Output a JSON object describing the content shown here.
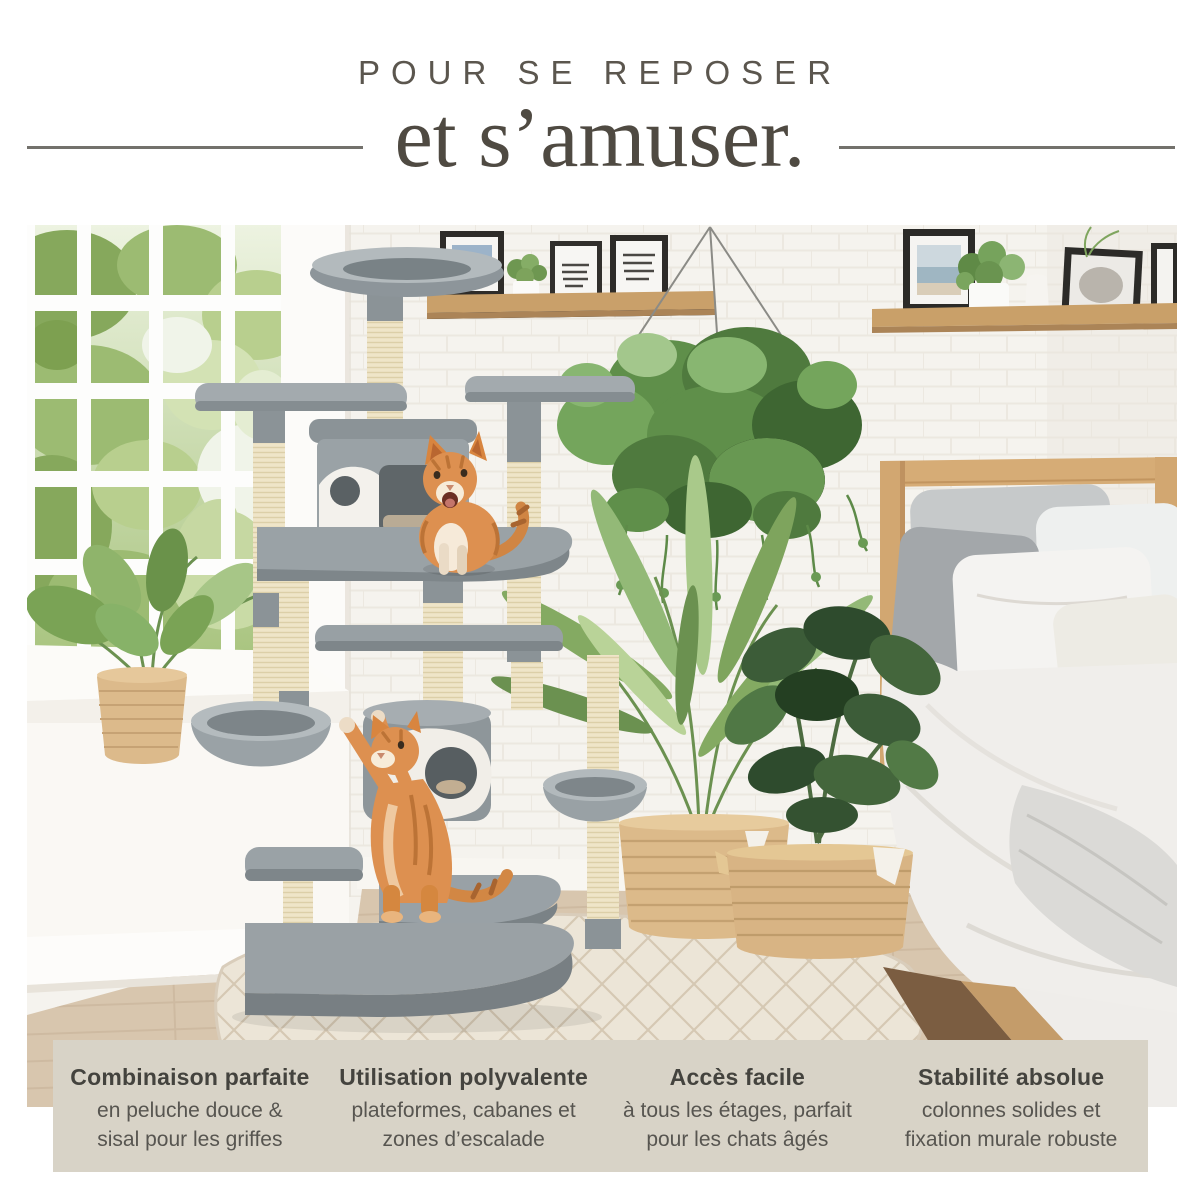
{
  "header": {
    "kicker": "POUR SE REPOSER",
    "headline": "et s’amuser."
  },
  "photo": {
    "alt": "Chambre lumineuse : arbre à chat gris clair avec colonnes en sisal, deux chatons roux, grande fenêtre, étagères murales, plante suspendue, plantes en paniers et lit en bois"
  },
  "features": {
    "items": [
      {
        "title": "Combinaison parfaite",
        "line1": "en peluche douce &",
        "line2": "sisal pour les griffes"
      },
      {
        "title": "Utilisation polyvalente",
        "line1": "plateformes, cabanes et",
        "line2": "zones d’escalade"
      },
      {
        "title": "Accès facile",
        "line1": "à tous les étages, parfait",
        "line2": "pour les chats âgés"
      },
      {
        "title": "Stabilité absolue",
        "line1": "colonnes solides et",
        "line2": "fixation murale robuste"
      }
    ]
  },
  "palette": {
    "panel_beige": "#d8d3c7",
    "kicker_text": "#5b564e",
    "headline_text": "#4f4a42",
    "rule_gray": "#73716c",
    "feature_title": "#44433e",
    "feature_body": "#575550",
    "wall_white": "#f5f3ee",
    "cat_tree_gray": "#99a1a5",
    "sisal_cream": "#efe5c8",
    "cat_orange": "#dd9050",
    "wood_shelf": "#c9a06a",
    "floor_wood": "#d8c6ae",
    "rug_cream": "#ece5d7"
  }
}
